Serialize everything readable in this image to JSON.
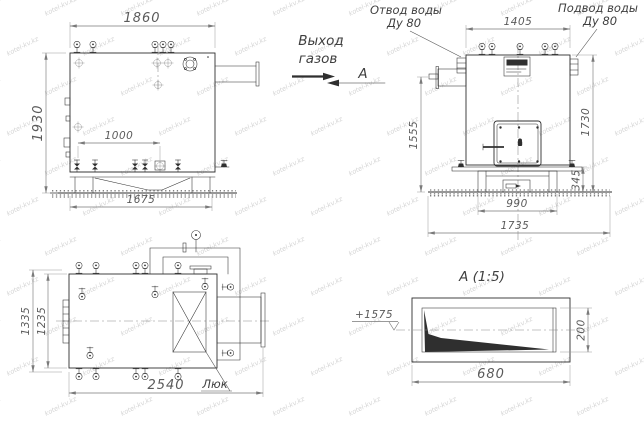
{
  "labels": {
    "gas_outlet_1": "Выход",
    "gas_outlet_2": "газов",
    "section_arrow_letter": "А",
    "water_outlet_1": "Отвод воды",
    "water_outlet_2": "Ду 80",
    "water_inlet_1": "Подвод воды",
    "water_inlet_2": "Ду 80",
    "hatch": "Люк",
    "section_title": "А (1:5)",
    "level_mark": "+1575"
  },
  "dims": {
    "side": {
      "top_width": "1860",
      "left_height": "1930",
      "inner_width": "1000",
      "base_width": "1675"
    },
    "front": {
      "top_width": "1405",
      "left_height": "1555",
      "right_height": "1730",
      "base_height": "345",
      "base_width": "990",
      "overall_width": "1735"
    },
    "plan": {
      "outer_height": "1335",
      "inner_height": "1235",
      "overall_length": "2540"
    },
    "section": {
      "height": "200",
      "width": "680"
    }
  },
  "watermark": {
    "text": "kotel-kv.kz",
    "color": "#d4d4d4"
  },
  "colors": {
    "line": "#2f2f2f",
    "dim_line": "#7a7a7a",
    "dim_text": "#5a5a5a",
    "label_text": "#3f3f3f",
    "background": "#ffffff"
  }
}
